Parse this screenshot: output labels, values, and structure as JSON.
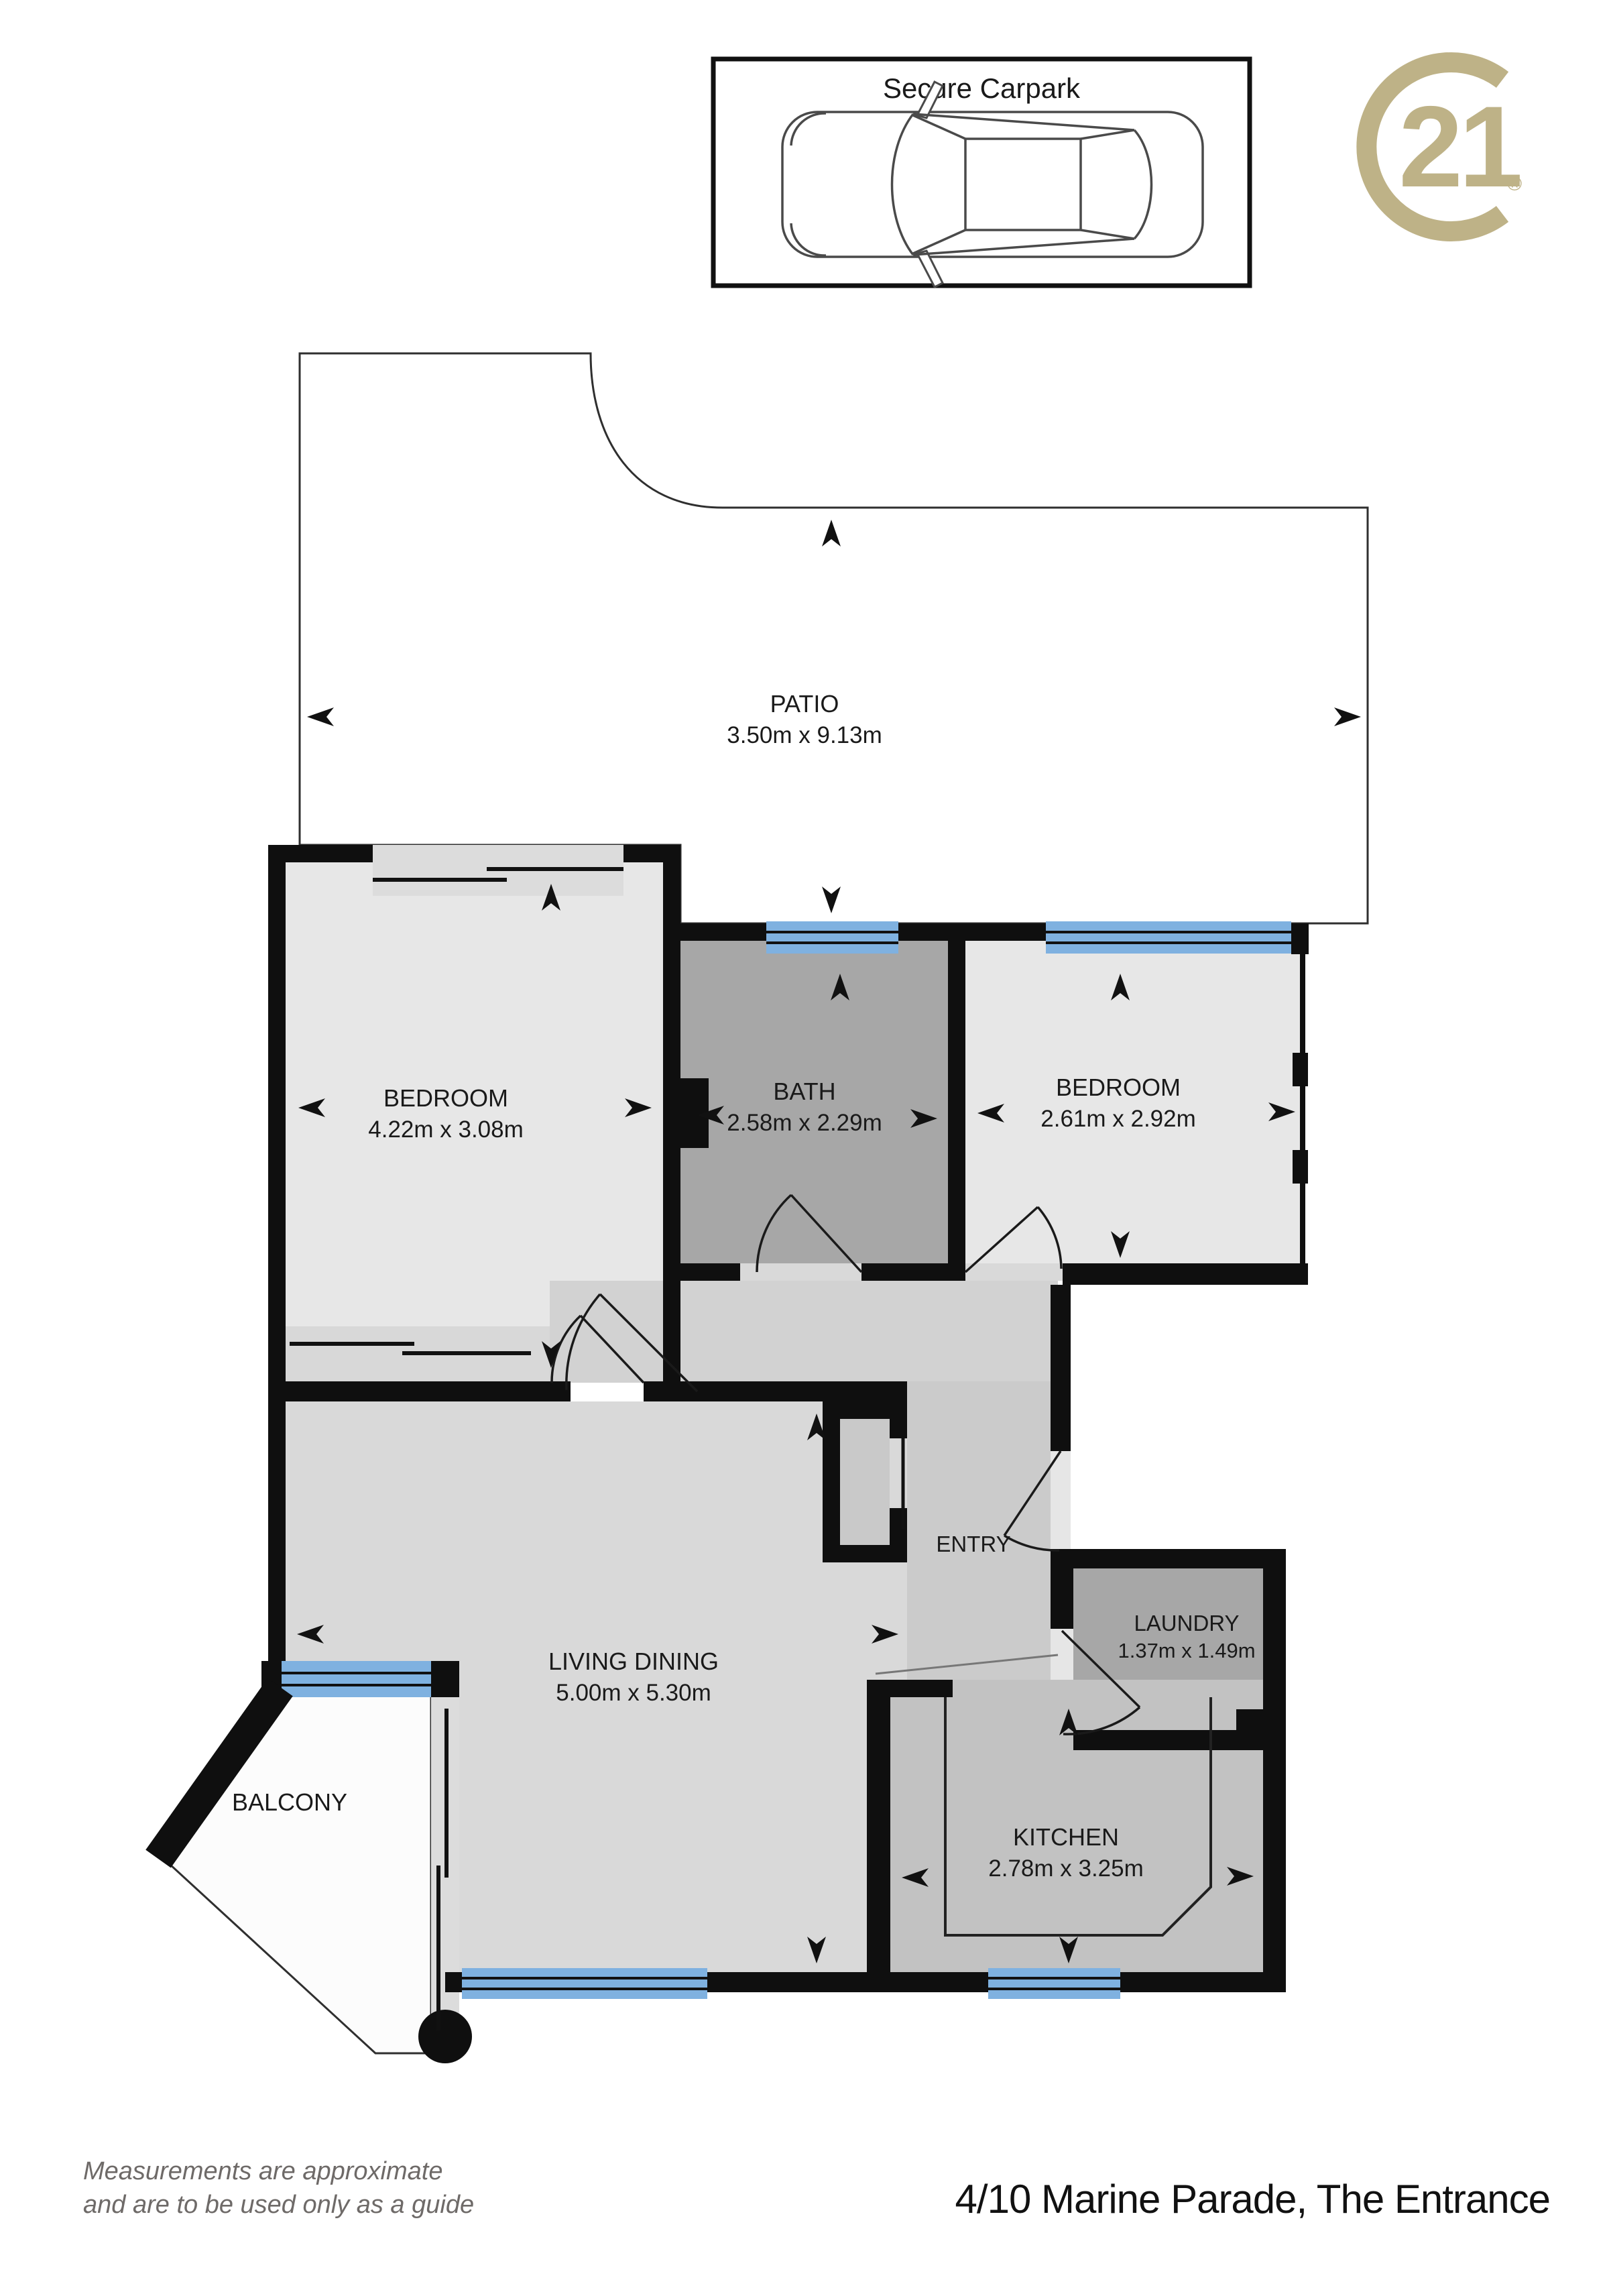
{
  "carpark": {
    "title": "Secure Carpark"
  },
  "logo": {
    "number": "21",
    "registered": "®",
    "brand_color": "#beb287"
  },
  "rooms": {
    "patio": {
      "name": "PATIO",
      "dims": "3.50m x 9.13m"
    },
    "bedroom1": {
      "name": "BEDROOM",
      "dims": "4.22m x 3.08m"
    },
    "bath": {
      "name": "BATH",
      "dims": "2.58m x 2.29m"
    },
    "bedroom2": {
      "name": "BEDROOM",
      "dims": "2.61m x 2.92m"
    },
    "living": {
      "name": "LIVING DINING",
      "dims": "5.00m x 5.30m"
    },
    "entry": {
      "name": "ENTRY"
    },
    "laundry": {
      "name": "LAUNDRY",
      "dims": "1.37m x 1.49m"
    },
    "kitchen": {
      "name": "KITCHEN",
      "dims": "2.78m x 3.25m"
    },
    "balcony": {
      "name": "BALCONY"
    }
  },
  "footer": {
    "disclaimer_line1": "Measurements are approximate",
    "disclaimer_line2": "and are to be used only as a guide",
    "address": "4/10 Marine Parade, The Entrance"
  },
  "colors": {
    "wall": "#0f0f0f",
    "window_blue": "#7fb1e0",
    "room_light": "#e7e7e7",
    "room_mid": "#d9d9d9",
    "room_dark": "#a7a7a7",
    "kitchen_gray": "#c2c2c2",
    "brand_gold": "#beb287"
  }
}
